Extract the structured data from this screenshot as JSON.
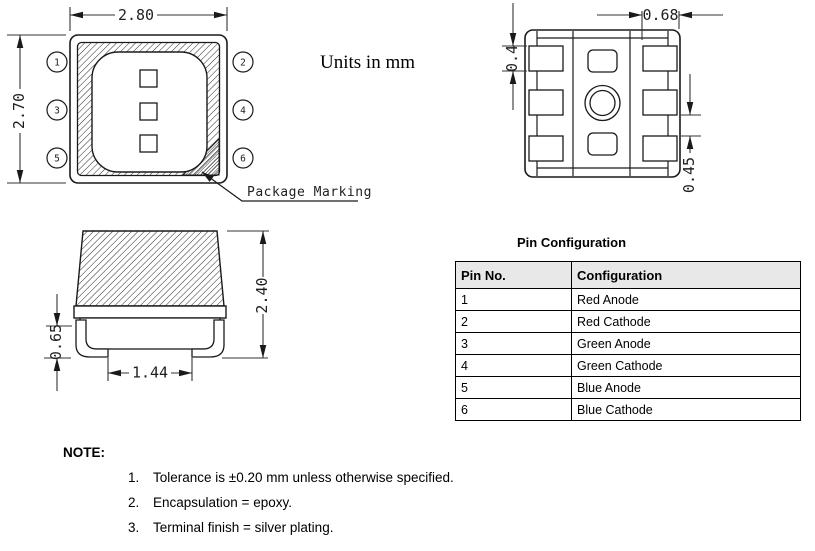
{
  "units_note": "Units in mm",
  "top_view": {
    "width_dim": "2.80",
    "height_dim": "2.70",
    "marking_label": "Package Marking",
    "pins": [
      "1",
      "2",
      "3",
      "4",
      "5",
      "6"
    ]
  },
  "bottom_view": {
    "pad_width_dim": "0.68",
    "pad_height_dim": "0.4",
    "pad_gap_dim": "0.45"
  },
  "side_view": {
    "total_height_dim": "2.40",
    "standoff_dim": "0.65",
    "lead_span_dim": "1.44"
  },
  "pin_table": {
    "title": "Pin Configuration",
    "headers": [
      "Pin No.",
      "Configuration"
    ],
    "rows": [
      [
        "1",
        "Red Anode"
      ],
      [
        "2",
        "Red Cathode"
      ],
      [
        "3",
        "Green Anode"
      ],
      [
        "4",
        "Green Cathode"
      ],
      [
        "5",
        "Blue Anode"
      ],
      [
        "6",
        "Blue Cathode"
      ]
    ]
  },
  "notes": {
    "label": "NOTE:",
    "items": [
      {
        "num": "1.",
        "text": "Tolerance is ±0.20 mm unless otherwise specified."
      },
      {
        "num": "2.",
        "text": "Encapsulation = epoxy."
      },
      {
        "num": "3.",
        "text": "Terminal finish = silver plating."
      }
    ]
  },
  "colors": {
    "line": "#1a1a1a",
    "table_header_bg": "#e8e8e8"
  }
}
